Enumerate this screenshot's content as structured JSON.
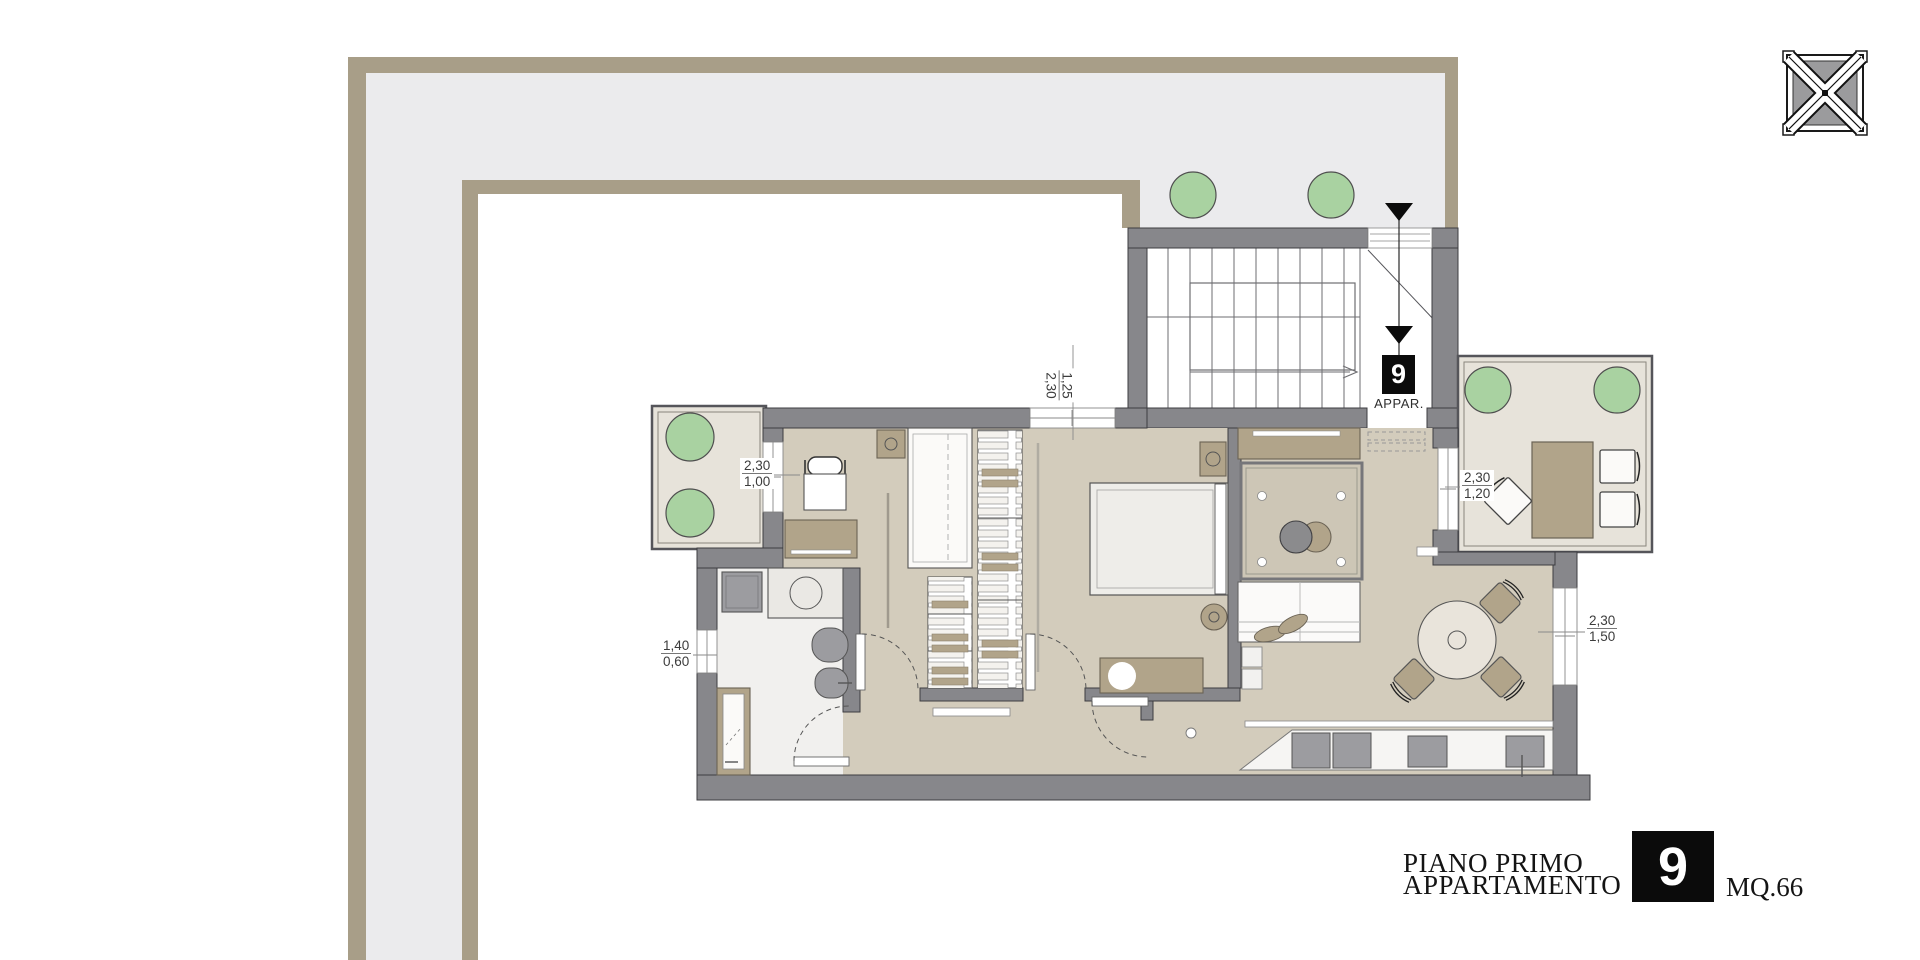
{
  "palette": {
    "wall_gray": "#87878b",
    "walkway_fill": "#ebebed",
    "tan_border": "#a89e88",
    "apartment_floor": "#d3ccbc",
    "terrace_floor": "#e7e3da",
    "bathroom_floor": "#f1f0ee",
    "furniture_brown": "#b1a48a",
    "plant_green": "#a9d2a1",
    "accent_black": "#0b0b0b"
  },
  "stairwell": {
    "entry_unit_number": "9",
    "entry_caption": "APPAR."
  },
  "dimensions": {
    "balcony_window": {
      "value_top": "2,30",
      "value_bottom": "1,00"
    },
    "bath_window": {
      "value_top": "1,40",
      "value_bottom": "0,60"
    },
    "hall_window": {
      "value_top": "1,25",
      "value_bottom": "2,30"
    },
    "terrace_window": {
      "value_top": "2,30",
      "value_bottom": "1,20"
    },
    "living_window": {
      "value_top": "2,30",
      "value_bottom": "1,50"
    }
  },
  "title_block": {
    "floor_label": "PIANO PRIMO",
    "type_label": "APPARTAMENTO",
    "unit_number": "9",
    "area_label": "MQ.66"
  },
  "icons": {
    "logo": "truss-logo",
    "plants": "plant-circle-icon",
    "entry_arrows": "entry-direction-arrow-icon"
  }
}
